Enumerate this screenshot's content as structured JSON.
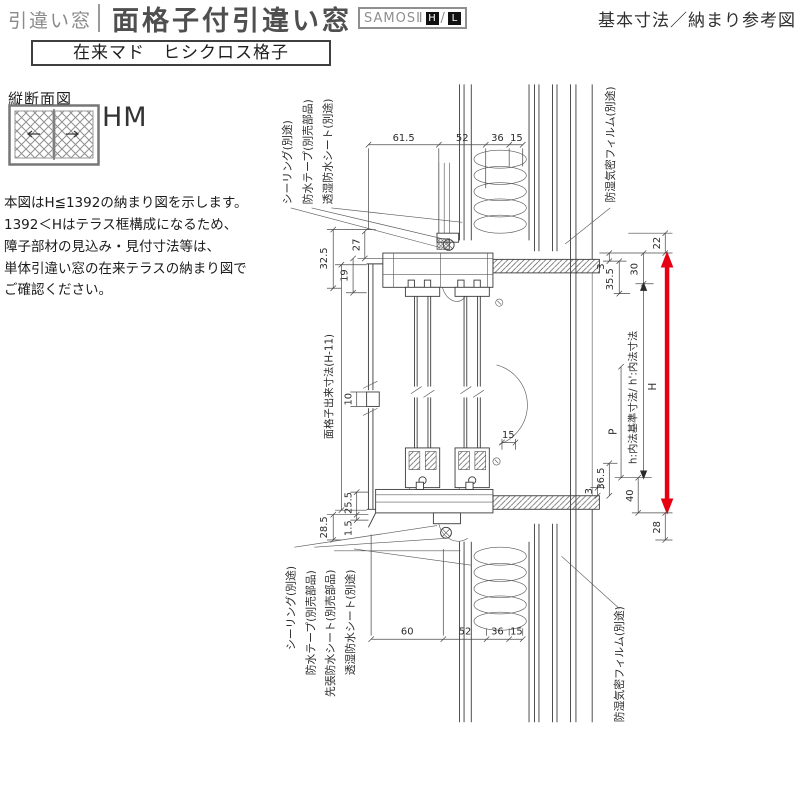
{
  "header": {
    "category": "引違い窓",
    "title": "面格子付引違い窓",
    "brand": "SAMOSⅡ",
    "brand_h": "H",
    "brand_slash": "/",
    "brand_l": "L",
    "right_note": "基本寸法／納まり参考図"
  },
  "subheader": "在来マド　ヒシクロス格子",
  "sidebar": {
    "section_view_label": "縦断面図",
    "window_code": "HM",
    "note_lines": [
      "本図はH≦1392の納まり図を示します。",
      "1392＜Hはテラス框構成になるため、",
      "障子部材の見込み・見付寸法等は、",
      "単体引違い窓の在来テラスの納まり図で",
      "ご確認ください。"
    ]
  },
  "drawing": {
    "callouts": {
      "top_left": [
        "シーリング(別途)",
        "防水テープ(別売部品)",
        "透湿防水シート(別途)"
      ],
      "top_right": "防湿気密フィルム(別途)",
      "bottom_left": [
        "シーリング(別途)",
        "防水テープ(別売部品)",
        "先張防水シート(別売部品)",
        "透湿防水シート(別途)"
      ],
      "bottom_right": "防湿気密フィルム(別途)"
    },
    "dims_top": [
      "61.5",
      "52",
      "36",
      "15"
    ],
    "dims_bottom": [
      "60",
      "52",
      "36",
      "15"
    ],
    "dims_left_head": [
      "32.5",
      "27",
      "19"
    ],
    "dims_right_head": [
      "22",
      "30",
      "3",
      "35.5"
    ],
    "dims_mid": [
      "10",
      "15"
    ],
    "dims_left_sill": [
      "25.5",
      "1.5",
      "28.5"
    ],
    "dims_right_sill": [
      "36.5",
      "3",
      "40",
      "28"
    ],
    "labels": {
      "inner_height": "h:内法基準寸法/ h':内法寸法",
      "overall_height": "H",
      "pitch": "P",
      "grille_height": "面格子出来寸法(H-11)"
    },
    "arrow_color": "#e60012"
  }
}
